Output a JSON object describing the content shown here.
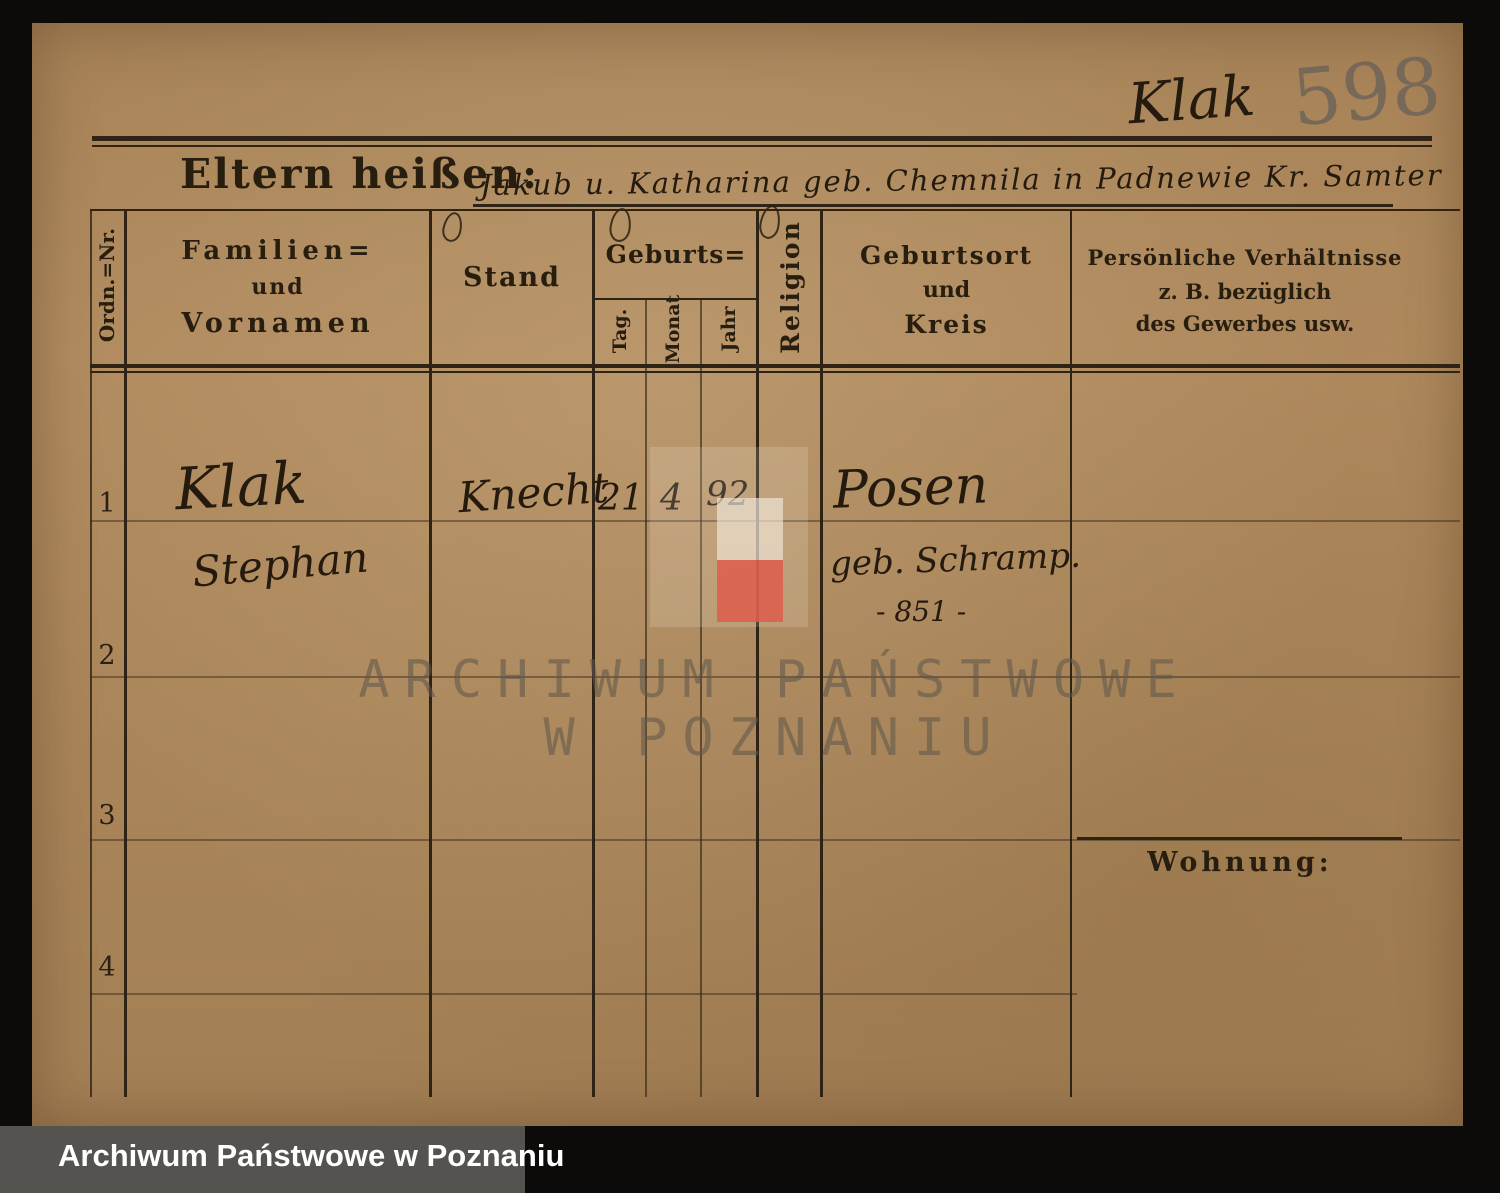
{
  "annotations": {
    "surname_top": "Klak",
    "number_top": "598"
  },
  "form": {
    "title": "Eltern heißen:",
    "title_entry": "Jakub u. Katharina geb. Chemnila in Padnewie Kr. Samter",
    "wohnung_label": "Wohnung:",
    "columns": {
      "ordn": "Ordn.=Nr.",
      "name_l1": "Familien=",
      "name_l2": "und",
      "name_l3": "Vornamen",
      "stand": "Stand",
      "geburts": "Geburts=",
      "tag": "Tag.",
      "monat": "Monat",
      "jahr": "Jahr",
      "religion": "Religion",
      "ort_l1": "Geburtsort",
      "ort_l2": "und",
      "ort_l3": "Kreis",
      "pers_l1": "Persönliche Verhältnisse",
      "pers_l2": "z. B. bezüglich",
      "pers_l3": "des Gewerbes usw."
    },
    "rows": [
      {
        "nr": "1",
        "name_line1": "Klak",
        "name_line2": "Stephan",
        "stand": "Knecht",
        "tag": "21",
        "monat": "4",
        "jahr": "92",
        "ort_line1": "Posen",
        "ort_line2": "geb. Schramp.",
        "ort_line3": "- 851 -"
      },
      {
        "nr": "2"
      },
      {
        "nr": "3"
      },
      {
        "nr": "4"
      }
    ]
  },
  "watermark": {
    "line1": "ARCHIWUM PAŃSTWOWE",
    "line2": "W POZNANIU"
  },
  "footer": {
    "archive_label": "Archiwum Państwowe w Poznaniu"
  },
  "colors": {
    "paper": "#b28c5f",
    "ink": "#241a0e",
    "print": "#281e10",
    "flag_red": "#dd5f4d",
    "flag_white": "#f3e9da",
    "footer_strip": "#55534f",
    "pencil": "#776d60"
  }
}
